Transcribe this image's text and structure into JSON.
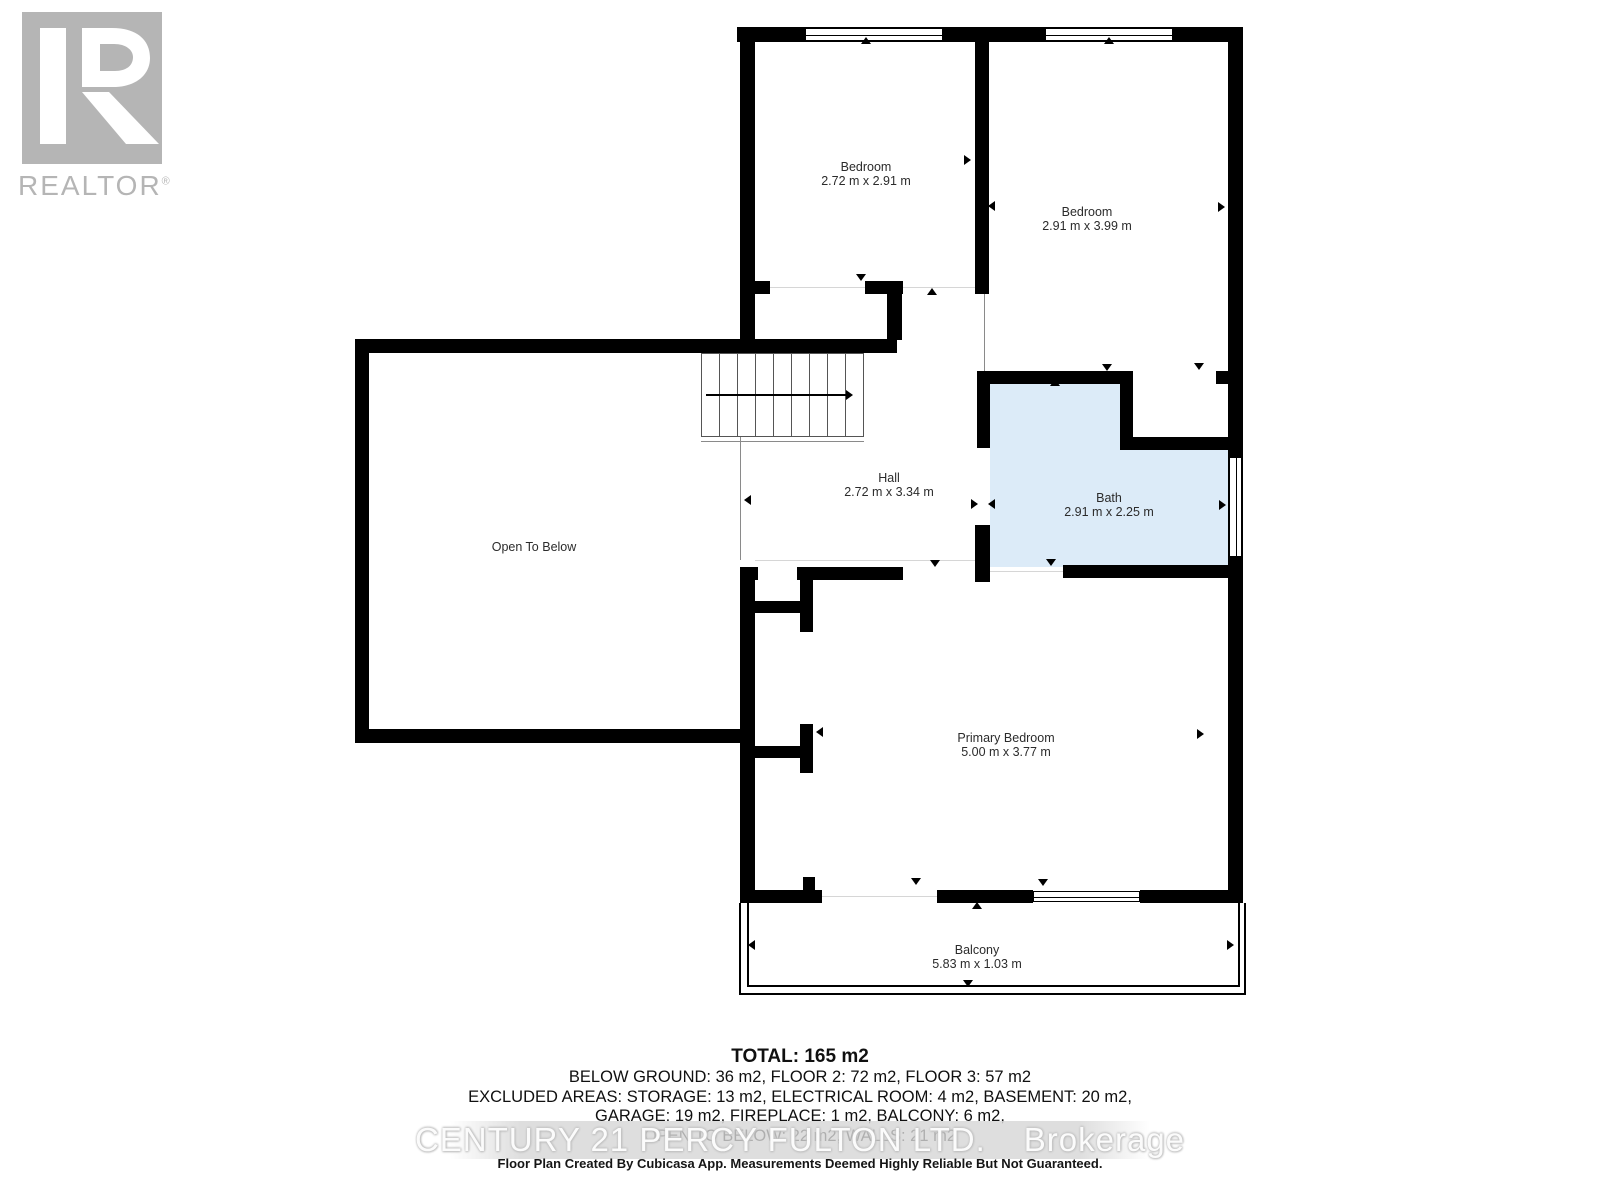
{
  "logo": {
    "text": "REALTOR",
    "registered": "®"
  },
  "rooms": [
    {
      "name": "Bedroom",
      "dims": "2.72 m x 2.91 m"
    },
    {
      "name": "Bedroom",
      "dims": "2.91 m x 3.99 m"
    },
    {
      "name": "Hall",
      "dims": "2.72 m x 3.34 m"
    },
    {
      "name": "Bath",
      "dims": "2.91 m x 2.25 m"
    },
    {
      "name": "Open To Below",
      "dims": ""
    },
    {
      "name": "Primary Bedroom",
      "dims": "5.00 m x 3.77 m"
    },
    {
      "name": "Balcony",
      "dims": "5.83 m x 1.03 m"
    }
  ],
  "summary": {
    "total": "TOTAL: 165 m2",
    "line2": "BELOW GROUND: 36 m2, FLOOR 2: 72 m2, FLOOR 3: 57 m2",
    "line3": "EXCLUDED AREAS: STORAGE: 13 m2, ELECTRICAL ROOM: 4 m2, BASEMENT: 20 m2,",
    "line4": "GARAGE: 19 m2, FIREPLACE: 1 m2, BALCONY: 6 m2,",
    "line5": "OPEN TO BELOW: 22 m2, WALLS: 21 m2"
  },
  "watermark": {
    "brand": "CENTURY 21 PERCY FULTON LTD.",
    "suffix": "Brokerage"
  },
  "footer": "Floor Plan Created By Cubicasa App. Measurements Deemed Highly Reliable But Not Guaranteed.",
  "colors": {
    "wall": "#000000",
    "bath_fill": "#dcebf8",
    "logo_gray": "#b5b5b5",
    "label_text": "#2b2b2b"
  },
  "markers": [
    {
      "dir": "up",
      "x": 861,
      "y": 37
    },
    {
      "dir": "up",
      "x": 1104,
      "y": 37
    },
    {
      "dir": "down",
      "x": 856,
      "y": 274
    },
    {
      "dir": "up",
      "x": 927,
      "y": 288
    },
    {
      "dir": "right",
      "x": 964,
      "y": 155
    },
    {
      "dir": "left",
      "x": 988,
      "y": 201
    },
    {
      "dir": "left",
      "x": 747,
      "y": 153
    },
    {
      "dir": "right",
      "x": 1218,
      "y": 202
    },
    {
      "dir": "down",
      "x": 1102,
      "y": 364
    },
    {
      "dir": "down",
      "x": 1194,
      "y": 363
    },
    {
      "dir": "up",
      "x": 1050,
      "y": 379
    },
    {
      "dir": "left",
      "x": 744,
      "y": 495
    },
    {
      "dir": "right",
      "x": 971,
      "y": 499
    },
    {
      "dir": "left",
      "x": 988,
      "y": 499
    },
    {
      "dir": "right",
      "x": 1219,
      "y": 500
    },
    {
      "dir": "down",
      "x": 1046,
      "y": 559
    },
    {
      "dir": "down",
      "x": 930,
      "y": 560
    },
    {
      "dir": "right",
      "x": 1197,
      "y": 729
    },
    {
      "dir": "left",
      "x": 816,
      "y": 727
    },
    {
      "dir": "down",
      "x": 911,
      "y": 878
    },
    {
      "dir": "down",
      "x": 1038,
      "y": 879
    },
    {
      "dir": "up",
      "x": 972,
      "y": 902
    },
    {
      "dir": "left",
      "x": 748,
      "y": 940
    },
    {
      "dir": "right",
      "x": 1227,
      "y": 940
    },
    {
      "dir": "down",
      "x": 963,
      "y": 980
    }
  ]
}
